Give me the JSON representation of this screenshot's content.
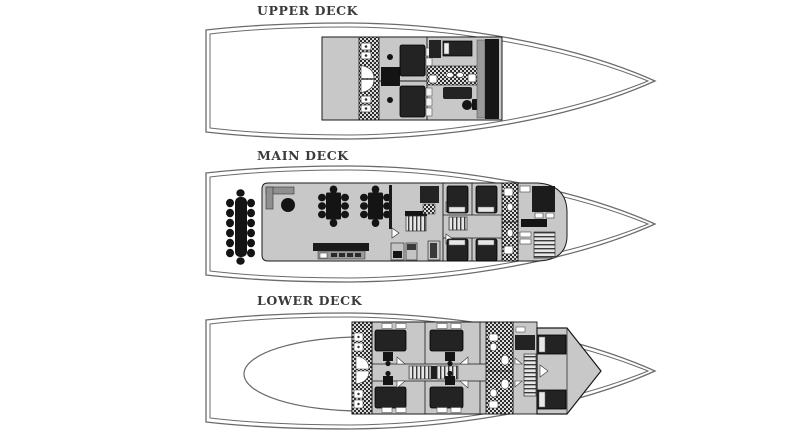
{
  "image": {
    "width": 800,
    "height": 434,
    "background": "#ffffff",
    "description": "Yacht general arrangement plan with three deck levels shown in profile-plan view, bow pointing right"
  },
  "decks": [
    {
      "id": "upper-deck",
      "label": "UPPER DECK",
      "features": [
        "open-aft-deck",
        "bathroom-strip",
        "two-double-cabins",
        "master-cabin",
        "helm-windshield"
      ]
    },
    {
      "id": "main-deck",
      "label": "MAIN DECK",
      "features": [
        "aft-dining-table-with-chairs",
        "salon-l-sofa",
        "coffee-table",
        "two-dining-tables",
        "bar-counter",
        "staircases",
        "four-guest-cabins",
        "bathroom-strip",
        "galley"
      ]
    },
    {
      "id": "lower-deck",
      "label": "LOWER DECK",
      "features": [
        "engine-room-outline",
        "bathroom-strips",
        "four-guest-cabins",
        "corridor-ladder-stairs",
        "crew-stairs",
        "bow-cabin"
      ]
    }
  ],
  "colors": {
    "background": "#ffffff",
    "hull_line": "#6b6b6b",
    "deck_fill": "#c8c8c8",
    "furniture_dark": "#1f1f1f",
    "mid_gray": "#8f8f8f",
    "hatch_dark": "#2e2e2e",
    "label_text": "#3b3b3b"
  }
}
